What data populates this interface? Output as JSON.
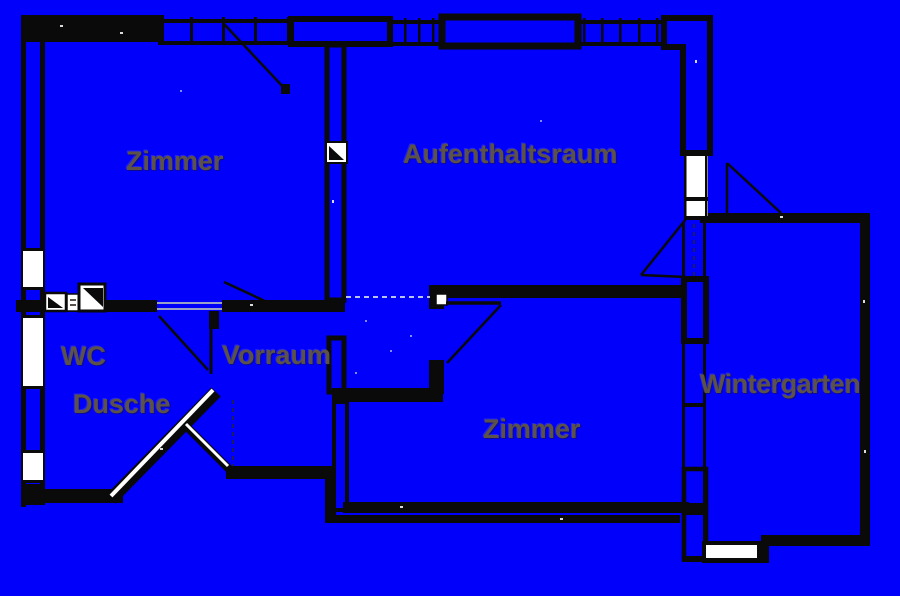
{
  "colors": {
    "background": "#0000fb",
    "walls": "#0a0a0a",
    "window_white": "#ffffff",
    "label": "#5c5247"
  },
  "rooms": [
    {
      "id": "zimmer-1",
      "label": "Zimmer"
    },
    {
      "id": "aufenthaltsraum",
      "label": "Aufenthaltsraum"
    },
    {
      "id": "wc",
      "label": "WC"
    },
    {
      "id": "dusche",
      "label": "Dusche"
    },
    {
      "id": "vorraum",
      "label": "Vorraum"
    },
    {
      "id": "zimmer-2",
      "label": "Zimmer"
    },
    {
      "id": "wintergarten",
      "label": "Wintergarten"
    }
  ],
  "fixtures": [
    "sink-symbol-small",
    "appliance-symbol",
    "sink-symbol-large",
    "shaft-symbol-partition",
    "door-hinge-marker"
  ]
}
